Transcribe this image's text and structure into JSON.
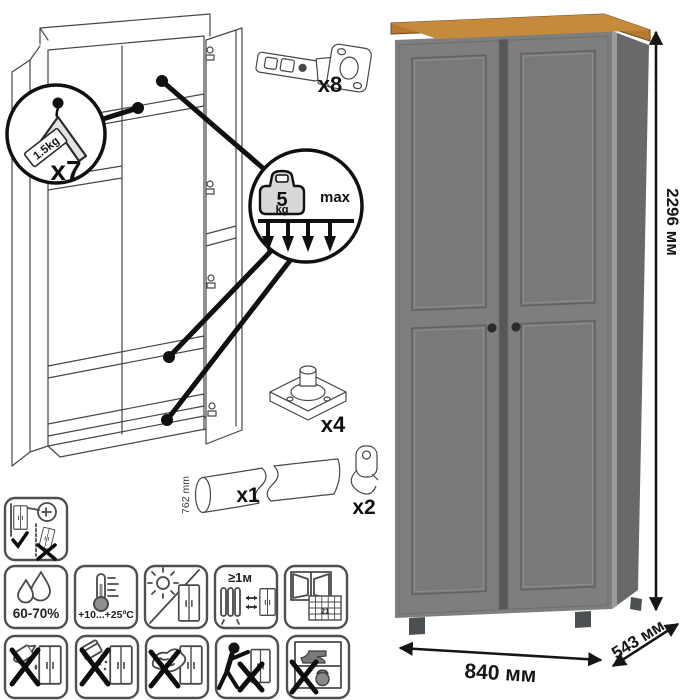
{
  "parts": {
    "hanger_qty": "x7",
    "hanger_capacity": "1.5kg",
    "hinge_qty": "x8",
    "shelf_load_value": "5",
    "shelf_load_unit": "kg",
    "shelf_load_max": "max",
    "foot_qty": "x4",
    "rod_qty": "x1",
    "rod_length": "762 mm",
    "hook_qty": "x2"
  },
  "dimensions": {
    "height": "2296 мм",
    "width": "840 мм",
    "depth": "543 мм"
  },
  "care": {
    "humidity": "60-70%",
    "temperature": "+10...+25ºC",
    "min_distance": "≥1м",
    "calendar_day": "21"
  },
  "care_icons": {
    "row1": [
      "secure-to-wall"
    ],
    "row2": [
      "humidity",
      "temperature",
      "avoid-direct-sunlight",
      "min-distance-from-heat",
      "ventilation"
    ],
    "row3": [
      "no-liquids",
      "no-abrasive-powder",
      "no-scrubbing",
      "no-dragging",
      "no-heavy-items"
    ]
  },
  "colors": {
    "door_gray": "#7d7f7e",
    "side_gray": "#686a69",
    "wood_top": "#b5792f",
    "knob": "#2a2b2c",
    "line_art": "#474747",
    "accent_black": "#101010"
  }
}
